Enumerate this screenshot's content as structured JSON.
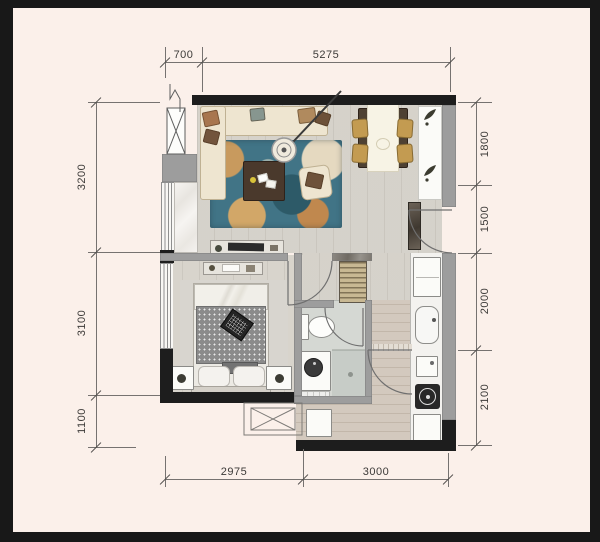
{
  "title": "apartment-floor-plan",
  "dimensions": {
    "top": [
      "700",
      "5275"
    ],
    "left": [
      "3200",
      "3100",
      "1100"
    ],
    "right": [
      "1800",
      "1500",
      "2000",
      "2100"
    ],
    "bottom": [
      "2975",
      "3000"
    ]
  },
  "colors": {
    "frame": "#181818",
    "paper": "#fbf0ea",
    "wall_dark": "#1d1d1d",
    "wall_gray": "#9d9d9d",
    "floor_wood": "#dbd8d1",
    "kitchen_wood": "#d3c9be",
    "rug_teal": "#417486",
    "sofa_cream": "#eee5d0",
    "chair_gold": "#c39b51",
    "table_brown": "#4a392c"
  },
  "furniture_icons": [
    "l-shaped-sofa",
    "area-rug",
    "coffee-table",
    "arc-floor-lamp",
    "armchair",
    "dining-table",
    "dining-chair",
    "entry-console",
    "tv-console",
    "dresser",
    "double-bed",
    "laptop",
    "nightstand",
    "wardrobe",
    "toilet",
    "washbasin",
    "shower-area",
    "refrigerator",
    "kitchen-sink",
    "gas-stove",
    "kitchen-cabinet",
    "washing-machine",
    "ac-platform",
    "casement-window",
    "sliding-window",
    "entry-door",
    "interior-door"
  ]
}
